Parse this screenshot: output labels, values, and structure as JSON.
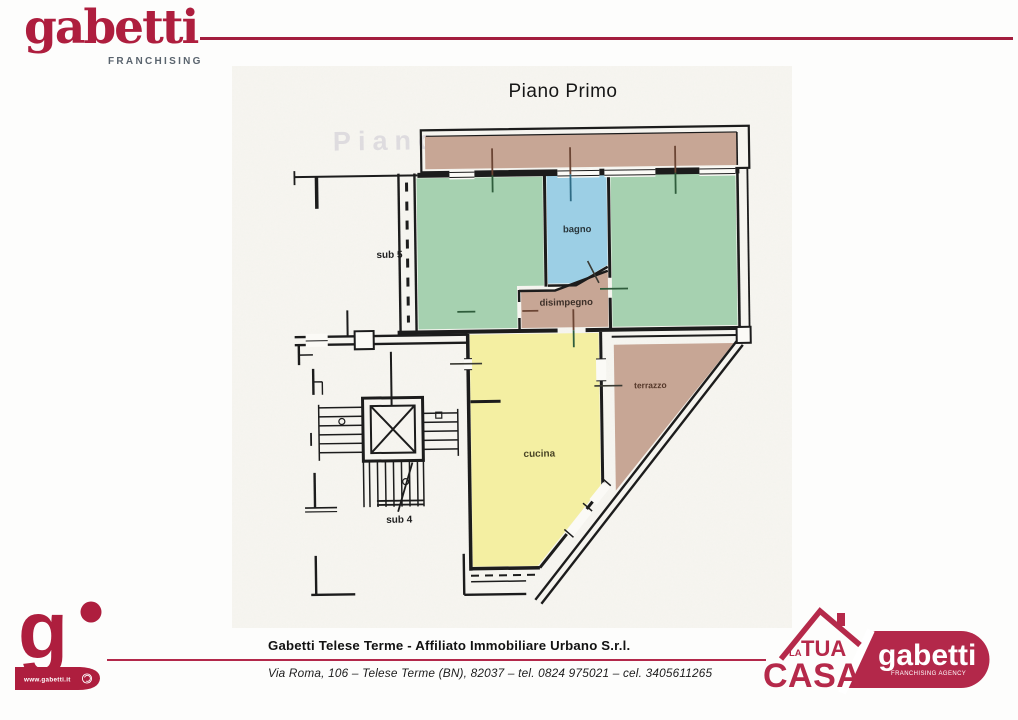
{
  "header": {
    "logo_text": "gabetti",
    "logo_subtext": "FRANCHISING",
    "brand_color": "#ae1e3e"
  },
  "plan": {
    "title": "Piano Primo",
    "watermark": "Piano",
    "labels": {
      "sub5": "sub 5",
      "sub4": "sub 4",
      "bagno": "bagno",
      "disimpegno": "disimpegno",
      "cucina": "cucina",
      "terrazzo": "terrazzo"
    },
    "colors": {
      "wall": "#1c1c1c",
      "scan_bg": "#f6f5f0",
      "gap_white": "#fbfaf6",
      "room_green": "#a6d1b0",
      "room_blue": "#9ccfe5",
      "room_brown": "#c7a695",
      "room_yellow": "#f4efa2",
      "tick_brown": "#6b4534",
      "tick_green": "#2f5d3c",
      "tick_blue": "#2e6b85",
      "tick_dark": "#3a3a33"
    }
  },
  "footer": {
    "agency_name": "Gabetti Telese Terme - Affiliato Immobiliare Urbano S.r.l.",
    "address": "Via Roma, 106 – Telese Terme (BN), 82037 – tel. 0824 975021 – cel. 3405611265",
    "website": "www.gabetti.it",
    "rule_color": "#b3284a",
    "casa_logo": {
      "la": "LA",
      "tua": "TUA",
      "casa": "CASA",
      "color": "#b5294a"
    },
    "pill": {
      "brand": "gabetti",
      "subtext": "FRANCHISING AGENCY",
      "color": "#b3284a"
    }
  }
}
